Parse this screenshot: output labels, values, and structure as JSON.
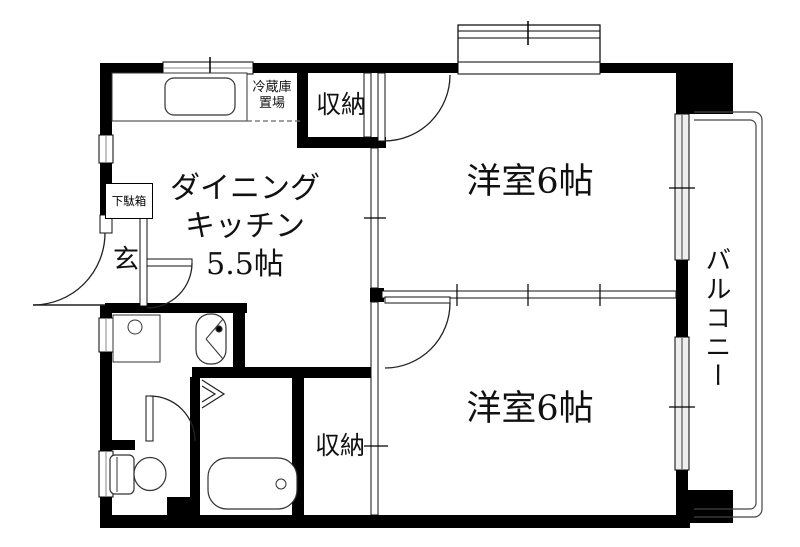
{
  "floorplan": {
    "labels": {
      "dining_kitchen_l1": "ダイニング",
      "dining_kitchen_l2": "キッチン",
      "dining_kitchen_l3": "5.5帖",
      "western_room_upper": "洋室6帖",
      "western_room_lower": "洋室6帖",
      "storage_upper": "収納",
      "storage_lower": "収納",
      "balcony": "バルコニー",
      "entrance": "玄",
      "shoe_cabinet": "下駄箱",
      "refrigerator_l1": "冷蔵庫",
      "refrigerator_l2": "置場"
    },
    "colors": {
      "wall": "#000000",
      "line": "#222222",
      "background": "#ffffff",
      "window_line": "#888888"
    }
  }
}
